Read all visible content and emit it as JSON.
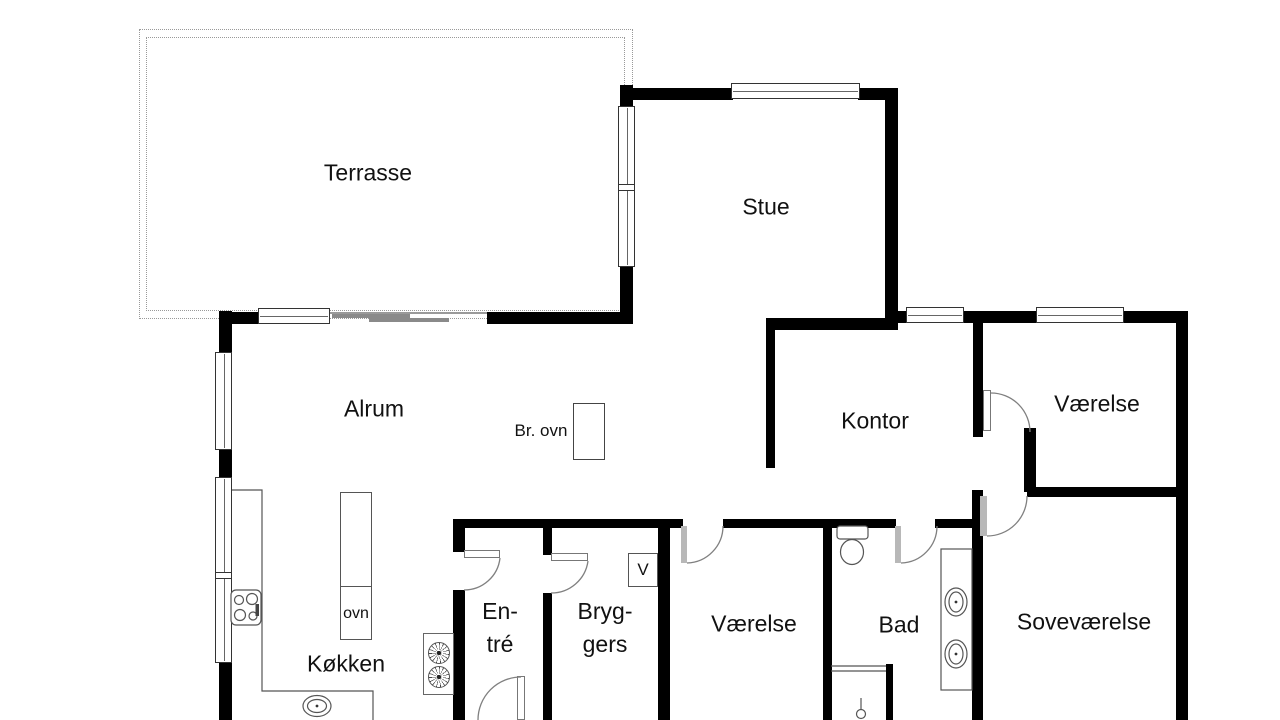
{
  "rooms": {
    "terrasse": "Terrasse",
    "stue": "Stue",
    "alrum": "Alrum",
    "kontor": "Kontor",
    "vaerelse_ne": "Værelse",
    "koekken": "Køkken",
    "entre_line1": "En-",
    "entre_line2": "tré",
    "bryggers_line1": "Bryg-",
    "bryggers_line2": "gers",
    "vaerelse_s": "Værelse",
    "bad": "Bad",
    "sovevaerelse": "Soveværelse"
  },
  "fixtures": {
    "wood_stove": "Br. ovn",
    "oven": "ovn",
    "vent": "V"
  },
  "colors": {
    "wall": "#000000",
    "door_leaf": "#b8b8b8",
    "door_arc": "#808080",
    "terrace_outline": "#999999"
  }
}
